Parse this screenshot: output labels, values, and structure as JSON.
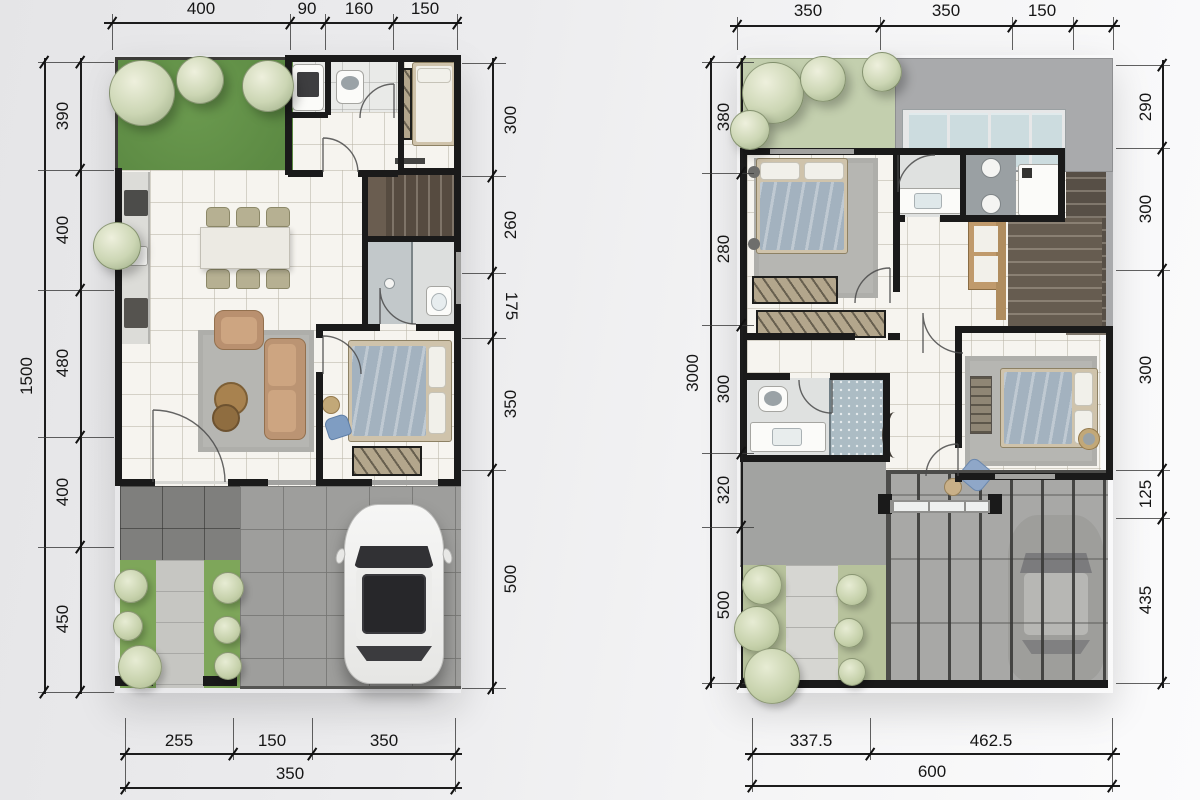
{
  "palette": {
    "wall": "#1a1a1a",
    "lawn": "#6b9a4f",
    "sage": "#c3cfae",
    "roof": "#a9aaac",
    "pave": "#9e9e9c",
    "blanket": "#a3b2bf",
    "wood": "#c09a6c"
  },
  "left_plan": {
    "top_dims": [
      "400",
      "90",
      "160",
      "150"
    ],
    "left_total": "1500",
    "left_dims": [
      "390",
      "400",
      "480",
      "400",
      "450"
    ],
    "right_dims": [
      "300",
      "260",
      "175",
      "350",
      "500"
    ],
    "bottom_dims": [
      "255",
      "150",
      "350"
    ],
    "bottom_total": "350"
  },
  "right_plan": {
    "top_dims": [
      "350",
      "350",
      "150"
    ],
    "left_total": "3000",
    "left_dims": [
      "380",
      "280",
      "300",
      "320",
      "500"
    ],
    "right_dims": [
      "290",
      "300",
      "300",
      "125",
      "435"
    ],
    "bottom_dims": [
      "337.5",
      "462.5"
    ],
    "bottom_total": "600"
  }
}
